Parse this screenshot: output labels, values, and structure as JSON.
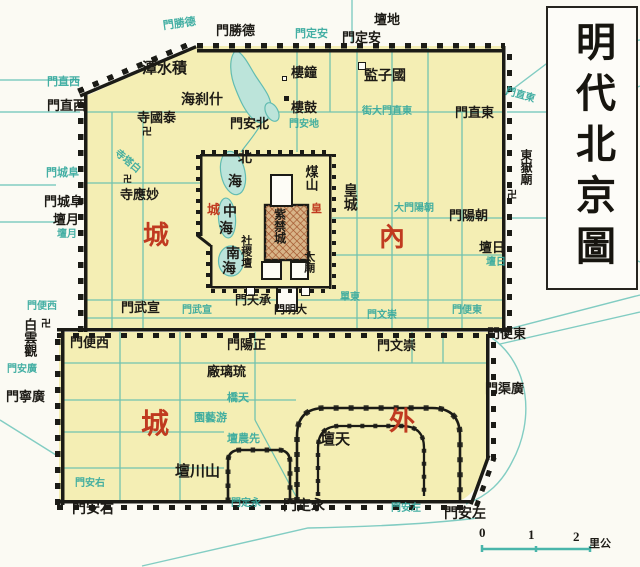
{
  "title": {
    "text": "明代北京圖"
  },
  "scale_bar": {
    "ticks": [
      "0",
      "1",
      "2"
    ],
    "unit": "里公"
  },
  "colors": {
    "city_fill": "#f4eeb4",
    "wall": "#1b1b16",
    "water": "#62bcb1",
    "street_label_cyan": "#35a99e",
    "district_red": "#c03a20",
    "ink": "#1d1b16"
  },
  "labels": [
    {
      "name": "ditan-label",
      "text": "壇地",
      "x": 374,
      "y": 13,
      "fs": 13,
      "cls": "k"
    },
    {
      "name": "andingmen-street-label",
      "text": "門定安",
      "x": 295,
      "y": 29,
      "fs": 11,
      "cls": "c"
    },
    {
      "name": "andingmen-label",
      "text": "門定安",
      "x": 342,
      "y": 31,
      "fs": 13,
      "cls": "k"
    },
    {
      "name": "deshengmen-street-label",
      "text": "門勝德",
      "x": 163,
      "y": 19,
      "fs": 11,
      "cls": "c",
      "rot": -8
    },
    {
      "name": "deshengmen-label",
      "text": "門勝德",
      "x": 216,
      "y": 24,
      "fs": 13,
      "cls": "k"
    },
    {
      "name": "dongzhimen-street-label",
      "text": "門直東",
      "x": 505,
      "y": 91,
      "fs": 10,
      "cls": "c",
      "rot": 16
    },
    {
      "name": "dongzhimen-label",
      "text": "門直東",
      "x": 455,
      "y": 106,
      "fs": 13,
      "cls": "k"
    },
    {
      "name": "xizhimen-street-label",
      "text": "門直西",
      "x": 47,
      "y": 77,
      "fs": 11,
      "cls": "c"
    },
    {
      "name": "xizhimen-label",
      "text": "門直西",
      "x": 47,
      "y": 99,
      "fs": 13,
      "cls": "k"
    },
    {
      "name": "jishuitan-label",
      "text": "潭水積",
      "x": 142,
      "y": 62,
      "fs": 15,
      "cls": "k"
    },
    {
      "name": "shichahai-label",
      "text": "海刹什",
      "x": 181,
      "y": 94,
      "fs": 14,
      "cls": "k"
    },
    {
      "name": "zhonglou-label",
      "text": "樓鐘",
      "x": 291,
      "y": 66,
      "fs": 13,
      "cls": "k"
    },
    {
      "name": "gulou-label",
      "text": "樓鼓",
      "x": 291,
      "y": 101,
      "fs": 13,
      "cls": "k"
    },
    {
      "name": "guozijian-label",
      "text": "監子國",
      "x": 364,
      "y": 70,
      "fs": 14,
      "cls": "k"
    },
    {
      "name": "taiguosi-label",
      "text": "寺國泰",
      "x": 137,
      "y": 111,
      "fs": 13,
      "cls": "k"
    },
    {
      "name": "taiguosi-swastika",
      "text": "卍",
      "x": 142,
      "y": 128,
      "fs": 10,
      "cls": "k"
    },
    {
      "name": "beianmen-label",
      "text": "門安北",
      "x": 230,
      "y": 117,
      "fs": 13,
      "cls": "k"
    },
    {
      "name": "dianmen-street-label",
      "text": "門安地",
      "x": 289,
      "y": 120,
      "fs": 10,
      "cls": "c"
    },
    {
      "name": "dongzhimen-inner-street-label",
      "text": "街大門直東",
      "x": 362,
      "y": 107,
      "fs": 10,
      "cls": "c"
    },
    {
      "name": "baitasi-street-label",
      "text": "寺塔白",
      "x": 112,
      "y": 157,
      "fs": 10,
      "cls": "c",
      "rot": 40
    },
    {
      "name": "miaoyingsi-swastika",
      "text": "卍",
      "x": 123,
      "y": 175,
      "fs": 9,
      "cls": "k"
    },
    {
      "name": "miaoyingsi-label",
      "text": "寺應妙",
      "x": 120,
      "y": 188,
      "fs": 13,
      "cls": "k"
    },
    {
      "name": "fuchengmen-street-label",
      "text": "門城阜",
      "x": 46,
      "y": 168,
      "fs": 11,
      "cls": "c"
    },
    {
      "name": "fuchengmen-label",
      "text": "門城阜",
      "x": 44,
      "y": 195,
      "fs": 13,
      "cls": "k"
    },
    {
      "name": "yuetan-label",
      "text": "壇月",
      "x": 53,
      "y": 213,
      "fs": 13,
      "cls": "k"
    },
    {
      "name": "yuetan-street-label",
      "text": "壇月",
      "x": 57,
      "y": 230,
      "fs": 10,
      "cls": "c"
    },
    {
      "name": "beihai-label-bei",
      "text": "北",
      "x": 238,
      "y": 152,
      "fs": 14,
      "cls": "k"
    },
    {
      "name": "beihai-label-hai",
      "text": "海",
      "x": 228,
      "y": 176,
      "fs": 14,
      "cls": "k"
    },
    {
      "name": "zhonghai-label-zhong",
      "text": "中",
      "x": 223,
      "y": 206,
      "fs": 14,
      "cls": "k"
    },
    {
      "name": "zhonghai-label-hai",
      "text": "海",
      "x": 219,
      "y": 223,
      "fs": 14,
      "cls": "k"
    },
    {
      "name": "nanhai-label-nan",
      "text": "南",
      "x": 226,
      "y": 248,
      "fs": 14,
      "cls": "k"
    },
    {
      "name": "nanhai-label-hai",
      "text": "海",
      "x": 222,
      "y": 263,
      "fs": 14,
      "cls": "k"
    },
    {
      "name": "huangcheng-red-cheng",
      "text": "城",
      "x": 207,
      "y": 203,
      "fs": 13,
      "cls": "r"
    },
    {
      "name": "huangcheng-red-huang",
      "text": "皇",
      "x": 311,
      "y": 204,
      "fs": 11,
      "cls": "r"
    },
    {
      "name": "meishan-label",
      "text": "煤山",
      "x": 302,
      "y": 165,
      "fs": 13,
      "cls": "k",
      "vert": true,
      "lh": 1.35
    },
    {
      "name": "huangcheng-label",
      "text": "皇城",
      "x": 337,
      "y": 183,
      "fs": 14,
      "cls": "k",
      "vert": true,
      "lh": 1.7
    },
    {
      "name": "zijincheng-label",
      "text": "紫禁城",
      "x": 271,
      "y": 208,
      "fs": 12,
      "cls": "k",
      "vert": true,
      "lh": 1.3
    },
    {
      "name": "shejitan-label",
      "text": "社稷壇",
      "x": 238,
      "y": 235,
      "fs": 11,
      "cls": "k",
      "vert": true,
      "lh": 1.25
    },
    {
      "name": "taimiao-label",
      "text": "太廟",
      "x": 301,
      "y": 251,
      "fs": 11,
      "cls": "k",
      "vert": true,
      "lh": 1.25
    },
    {
      "name": "chengtianmen-label",
      "text": "門天承",
      "x": 235,
      "y": 294,
      "fs": 12,
      "cls": "k"
    },
    {
      "name": "damingmen-label",
      "text": "門明大",
      "x": 274,
      "y": 305,
      "fs": 11,
      "cls": "k"
    },
    {
      "name": "dongdan-street-label",
      "text": "單東",
      "x": 340,
      "y": 293,
      "fs": 10,
      "cls": "c"
    },
    {
      "name": "neicheng-label-nei",
      "text": "內",
      "x": 379,
      "y": 224,
      "fs": 26,
      "cls": "r"
    },
    {
      "name": "neicheng-label-cheng",
      "text": "城",
      "x": 143,
      "y": 222,
      "fs": 26,
      "cls": "r"
    },
    {
      "name": "dongyuemiao-label",
      "text": "東嶽廟",
      "x": 518,
      "y": 149,
      "fs": 12,
      "cls": "k",
      "vert": true,
      "lh": 1.25
    },
    {
      "name": "dongyuemiao-swastika",
      "text": "卍",
      "x": 507,
      "y": 191,
      "fs": 10,
      "cls": "k"
    },
    {
      "name": "chaoyangmen-street-label",
      "text": "大門陽朝",
      "x": 394,
      "y": 204,
      "fs": 10,
      "cls": "c"
    },
    {
      "name": "chaoyangmen-label",
      "text": "門陽朝",
      "x": 449,
      "y": 209,
      "fs": 13,
      "cls": "k"
    },
    {
      "name": "ritan-label",
      "text": "壇日",
      "x": 479,
      "y": 241,
      "fs": 13,
      "cls": "k"
    },
    {
      "name": "ritan-street-label",
      "text": "壇日",
      "x": 486,
      "y": 258,
      "fs": 10,
      "cls": "c"
    },
    {
      "name": "xuanwumen-label",
      "text": "門武宣",
      "x": 121,
      "y": 301,
      "fs": 13,
      "cls": "k"
    },
    {
      "name": "xuanwumen-street-label",
      "text": "門武宣",
      "x": 182,
      "y": 306,
      "fs": 10,
      "cls": "c"
    },
    {
      "name": "xibianmen-street-label",
      "text": "門便西",
      "x": 27,
      "y": 302,
      "fs": 10,
      "cls": "c"
    },
    {
      "name": "xibianmen-label",
      "text": "門便西",
      "x": 70,
      "y": 336,
      "fs": 13,
      "cls": "k"
    },
    {
      "name": "baiyunguan-swastika",
      "text": "卍",
      "x": 41,
      "y": 320,
      "fs": 10,
      "cls": "k"
    },
    {
      "name": "baiyunguan-label",
      "text": "白雲觀",
      "x": 21,
      "y": 318,
      "fs": 13,
      "cls": "k",
      "vert": true,
      "lh": 1.25
    },
    {
      "name": "guangningmen-street-label",
      "text": "門安廣",
      "x": 7,
      "y": 365,
      "fs": 10,
      "cls": "c"
    },
    {
      "name": "guangningmen-label",
      "text": "門寧廣",
      "x": 6,
      "y": 390,
      "fs": 13,
      "cls": "k"
    },
    {
      "name": "zhengyangmen-label",
      "text": "門陽正",
      "x": 227,
      "y": 338,
      "fs": 13,
      "cls": "k"
    },
    {
      "name": "chongwenmen-street-label",
      "text": "門文崇",
      "x": 367,
      "y": 311,
      "fs": 10,
      "cls": "c"
    },
    {
      "name": "chongwenmen-label",
      "text": "門文崇",
      "x": 377,
      "y": 339,
      "fs": 13,
      "cls": "k"
    },
    {
      "name": "dongbianmen-street-label",
      "text": "門便東",
      "x": 452,
      "y": 306,
      "fs": 10,
      "cls": "c"
    },
    {
      "name": "dongbianmen-label",
      "text": "門便東",
      "x": 487,
      "y": 327,
      "fs": 13,
      "cls": "k"
    },
    {
      "name": "guangqumen-label",
      "text": "門渠廣",
      "x": 485,
      "y": 382,
      "fs": 13,
      "cls": "k"
    },
    {
      "name": "liulichang-label",
      "text": "廠璃琉",
      "x": 207,
      "y": 365,
      "fs": 13,
      "cls": "k"
    },
    {
      "name": "tianqiao-label",
      "text": "橋天",
      "x": 227,
      "y": 393,
      "fs": 11,
      "cls": "c"
    },
    {
      "name": "youyiyuan-label",
      "text": "園藝游",
      "x": 194,
      "y": 413,
      "fs": 11,
      "cls": "c"
    },
    {
      "name": "xiannongtan-label",
      "text": "壇農先",
      "x": 227,
      "y": 434,
      "fs": 11,
      "cls": "c"
    },
    {
      "name": "waicheng-label-wai",
      "text": "外",
      "x": 389,
      "y": 408,
      "fs": 26,
      "cls": "r"
    },
    {
      "name": "waicheng-label-cheng",
      "text": "城",
      "x": 141,
      "y": 410,
      "fs": 28,
      "cls": "r"
    },
    {
      "name": "shanchuantan-label",
      "text": "壇川山",
      "x": 175,
      "y": 465,
      "fs": 15,
      "cls": "k"
    },
    {
      "name": "tiantan-label",
      "text": "壇天",
      "x": 320,
      "y": 433,
      "fs": 15,
      "cls": "k"
    },
    {
      "name": "youanmen-street-label",
      "text": "門安右",
      "x": 75,
      "y": 479,
      "fs": 10,
      "cls": "c"
    },
    {
      "name": "youanmen-label",
      "text": "門安右",
      "x": 72,
      "y": 503,
      "fs": 14,
      "cls": "k"
    },
    {
      "name": "yongdingmen-street-label",
      "text": "門定永",
      "x": 231,
      "y": 499,
      "fs": 10,
      "cls": "c"
    },
    {
      "name": "yongdingmen-label",
      "text": "門定永",
      "x": 283,
      "y": 500,
      "fs": 14,
      "cls": "k"
    },
    {
      "name": "zuoanmen-street-label",
      "text": "門安左",
      "x": 391,
      "y": 504,
      "fs": 10,
      "cls": "c"
    },
    {
      "name": "zuoanmen-label",
      "text": "門安左",
      "x": 444,
      "y": 508,
      "fs": 14,
      "cls": "k"
    },
    {
      "name": "scale-tick-0",
      "text": "0",
      "x": 479,
      "y": 526,
      "fs": 13,
      "cls": "k"
    },
    {
      "name": "scale-tick-1",
      "text": "1",
      "x": 528,
      "y": 528,
      "fs": 13,
      "cls": "k"
    },
    {
      "name": "scale-tick-2",
      "text": "2",
      "x": 573,
      "y": 530,
      "fs": 13,
      "cls": "k"
    },
    {
      "name": "scale-unit",
      "text": "里公",
      "x": 589,
      "y": 539,
      "fs": 11,
      "cls": "k"
    }
  ],
  "markers": [
    {
      "name": "guozijian-marker",
      "x": 358,
      "y": 62,
      "w": 8,
      "h": 8,
      "style": "open"
    },
    {
      "name": "zhonglou-marker",
      "x": 282,
      "y": 76,
      "w": 5,
      "h": 5,
      "style": "open"
    },
    {
      "name": "gulou-marker",
      "x": 284,
      "y": 96,
      "w": 5,
      "h": 5,
      "style": "fill"
    },
    {
      "name": "chengtianmen-west-marker",
      "x": 246,
      "y": 287,
      "w": 9,
      "h": 9,
      "style": "open"
    },
    {
      "name": "chengtianmen-east-marker",
      "x": 301,
      "y": 287,
      "w": 9,
      "h": 9,
      "style": "open"
    }
  ]
}
